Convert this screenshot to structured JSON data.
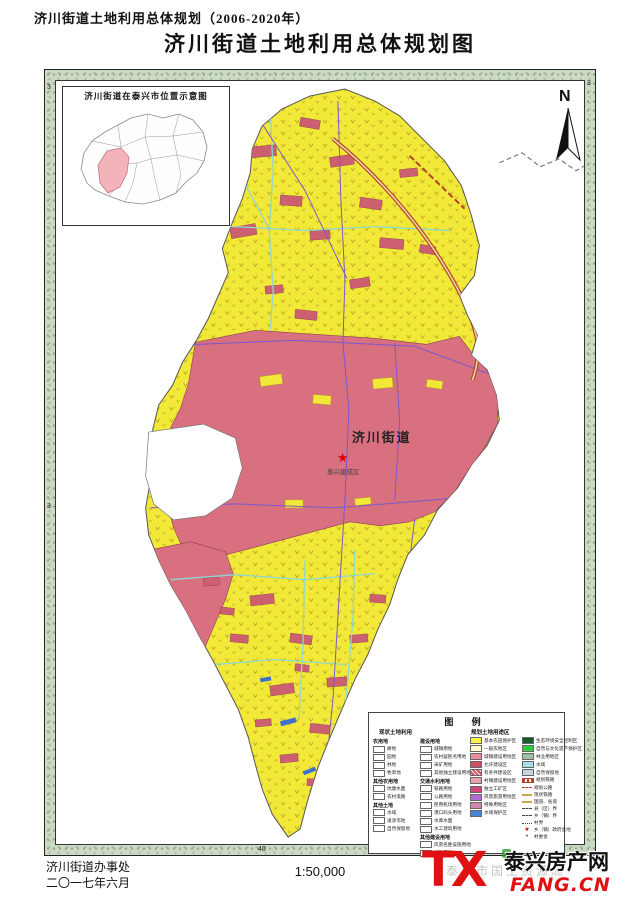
{
  "page": {
    "header_small": "济川街道土地利用总体规划（2006-2020年）",
    "title": "济川街道土地利用总体规划图"
  },
  "inset": {
    "title": "济川街道在泰兴市位置示意图"
  },
  "north": {
    "label": "N"
  },
  "map": {
    "center_label": "济川街道",
    "urban_label": "泰兴建成区",
    "ticks": {
      "left_top": "3",
      "right_top": "3",
      "left_mid": "3",
      "bottom_left": "40",
      "bottom_right": "40"
    }
  },
  "palette": {
    "farmland_yellow": "#f2e838",
    "urban_pink": "#d97080",
    "village_pink": "#cd6070",
    "river_cyan": "#8fd8cf",
    "road_purple": "#7a58cc",
    "expressway_red": "#b5432c",
    "water_blue": "#3f6fd0",
    "logo_red": "#e01111"
  },
  "legend": {
    "title": "图  例",
    "current_header": "现状土地利用",
    "plan_header": "规划土地用途区",
    "colA": [
      {
        "header": "农用地",
        "items": [
          {
            "label": "耕地"
          },
          {
            "label": "园地"
          },
          {
            "label": "林地"
          },
          {
            "label": "牧草地"
          }
        ]
      },
      {
        "header": "其他农用地",
        "items": [
          {
            "label": "坑塘水面"
          },
          {
            "label": "农村道路"
          }
        ]
      },
      {
        "header": "其他土地",
        "items": [
          {
            "label": "水域"
          },
          {
            "label": "滩涂苇地"
          },
          {
            "label": "自然保留地"
          }
        ]
      }
    ],
    "colB": [
      {
        "header": "建设用地",
        "items": [
          {
            "label": "城镇用地"
          },
          {
            "label": "农村居民点用地"
          },
          {
            "label": "采矿用地"
          },
          {
            "label": "其他独立建设用地"
          }
        ]
      },
      {
        "header": "交通水利用地",
        "items": [
          {
            "label": "铁路用地"
          },
          {
            "label": "公路用地"
          },
          {
            "label": "民用机场用地"
          },
          {
            "label": "港口码头用地"
          },
          {
            "label": "水库水面"
          },
          {
            "label": "水工建筑用地"
          }
        ]
      },
      {
        "header": "其他建设用地",
        "items": [
          {
            "label": "风景名胜设施用地"
          },
          {
            "label": "特殊用地"
          }
        ]
      }
    ],
    "colC": [
      {
        "label": "基本农田保护区",
        "color": "#f8f344"
      },
      {
        "label": "一般农地区",
        "color": "#fdfacc"
      },
      {
        "label": "城镇建设用地区",
        "color": "#e98e9a"
      },
      {
        "label": "允许建设区",
        "color": "#cf5064"
      },
      {
        "label": "有条件建设区",
        "color": "#cf5064",
        "style": "hatch"
      },
      {
        "label": "村镇建设用地区",
        "color": "#e8a0ac"
      },
      {
        "label": "独立工矿区",
        "color": "#d4457f"
      },
      {
        "label": "风景旅游用地区",
        "color": "#b06ad0"
      },
      {
        "label": "特殊用地区",
        "color": "#d088b0"
      },
      {
        "label": "水域保护区",
        "color": "#4a86d8"
      }
    ],
    "colD": [
      {
        "label": "生态环境安全控制区",
        "color": "#145c28"
      },
      {
        "label": "自然与文化遗产保护区",
        "color": "#2ecc40"
      },
      {
        "label": "林业用地区",
        "color": "#9fbf9f"
      },
      {
        "label": "水域",
        "color": "#a8dce8"
      },
      {
        "label": "自然保留地",
        "color": "#c4d4dc"
      },
      {
        "label": "规划铁路",
        "style": "rail"
      },
      {
        "label": "规划公路",
        "style": "dash-red"
      },
      {
        "label": "现状铁路",
        "style": "tan"
      },
      {
        "label": "国道、省道",
        "style": "tan-dash"
      },
      {
        "label": "县（区）界",
        "style": "dash"
      },
      {
        "label": "乡（镇）界",
        "style": "dash-dot"
      },
      {
        "label": "村界",
        "style": "dot"
      },
      {
        "label": "乡（镇）政府驻地",
        "style": "star"
      },
      {
        "label": "村委会",
        "style": "dot-sym"
      }
    ]
  },
  "footer": {
    "agency": "济川街道办事处",
    "date": "二〇一七年六月",
    "scale": "1:50,000",
    "watermark": "泰兴市国土资源局",
    "logo_tx": "TX",
    "logo_name": "泰兴房产网",
    "logo_domain": "FANG.CN"
  }
}
